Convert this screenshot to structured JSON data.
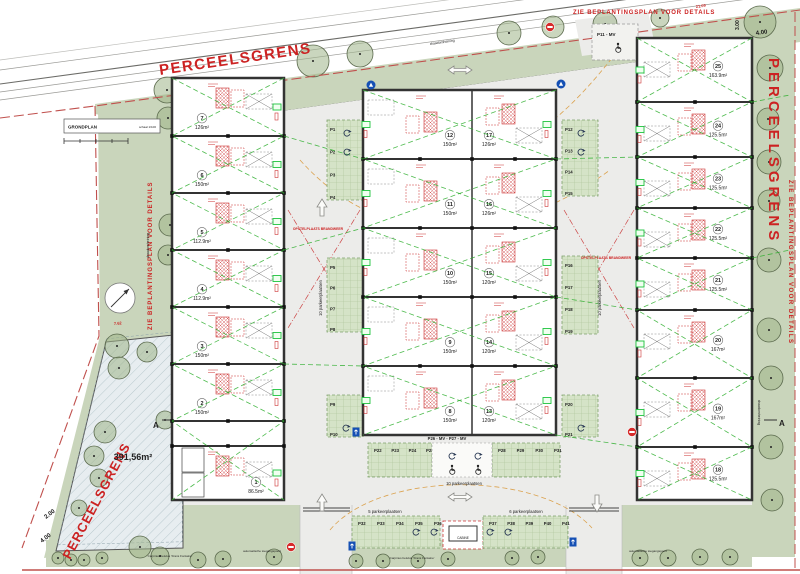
{
  "texts": {
    "perceelsgrens": "PERCEELSGRENS",
    "planting": "ZIE BEPLANTINGSPLAN VOOR DETAILS",
    "fence": "draadomheining",
    "title": "GRONDPLAN",
    "scale": "schaal 1/100",
    "green_area": "391,56m²",
    "section": "A",
    "fire": "OPSTELPLAATS BRANDWEER",
    "gate": "automatische toegangspoort",
    "species": "Carpinus betulus 'Frans Fontaine'",
    "p11": "P11 - MV",
    "mv_row": "P26 - MV - P27 - MV",
    "cabine": "CABINE",
    "count10": "10 parkeerplaatsen",
    "count5": "5 parkeerplaatsen",
    "count6": "6 parkeerplaatsen"
  },
  "dimensions": {
    "top_len": "21.09",
    "top_w": "4.00",
    "top_h": "3.00",
    "left_len": "7.62",
    "bottom_left_1": "2.00",
    "bottom_left_2": "4.00"
  },
  "units": {
    "left": [
      {
        "no": "7",
        "area": "126m²"
      },
      {
        "no": "6",
        "area": "150m²"
      },
      {
        "no": "5",
        "area": "112.9m²"
      },
      {
        "no": "4",
        "area": "112.9m²"
      },
      {
        "no": "3",
        "area": "150m²"
      },
      {
        "no": "2",
        "area": "150m²"
      },
      {
        "no": "1",
        "area": "86.5m²"
      }
    ],
    "center_left": [
      {
        "no": "12",
        "area": "150m²"
      },
      {
        "no": "11",
        "area": "150m²"
      },
      {
        "no": "10",
        "area": "150m²"
      },
      {
        "no": "9",
        "area": "150m²"
      },
      {
        "no": "8",
        "area": "150m²"
      }
    ],
    "center_right": [
      {
        "no": "17",
        "area": "126m²"
      },
      {
        "no": "16",
        "area": "126m²"
      },
      {
        "no": "15",
        "area": "120m²"
      },
      {
        "no": "14",
        "area": "120m²"
      },
      {
        "no": "13",
        "area": "120m²"
      }
    ],
    "right": [
      {
        "no": "25",
        "area": "163.9m²"
      },
      {
        "no": "24",
        "area": "125.5m²"
      },
      {
        "no": "23",
        "area": "125.5m²"
      },
      {
        "no": "22",
        "area": "125.5m²"
      },
      {
        "no": "21",
        "area": "125.5m²"
      },
      {
        "no": "20",
        "area": "167m²"
      },
      {
        "no": "19",
        "area": "167m²"
      },
      {
        "no": "18",
        "area": "125.5m²"
      }
    ]
  },
  "parking": {
    "court_left_top": [
      "P1",
      "P2",
      "P3",
      "P4"
    ],
    "court_left_mid": [
      "P5",
      "P6",
      "P7",
      "P8"
    ],
    "court_left_bottom": [
      "P9",
      "P10"
    ],
    "court_right_top": [
      "P12",
      "P13",
      "P14",
      "P15"
    ],
    "court_right_mid": [
      "P16",
      "P17",
      "P18",
      "P19"
    ],
    "court_right_bottom": [
      "P20",
      "P21"
    ],
    "inner_row_left": [
      "P22",
      "P23",
      "P24",
      "P25"
    ],
    "inner_row_right": [
      "P28",
      "P29",
      "P30",
      "P31"
    ],
    "south_row_left": [
      "P32",
      "P33",
      "P34",
      "P35",
      "P36"
    ],
    "south_row_right": [
      "P37",
      "P38",
      "P39",
      "P40",
      "P41"
    ]
  }
}
